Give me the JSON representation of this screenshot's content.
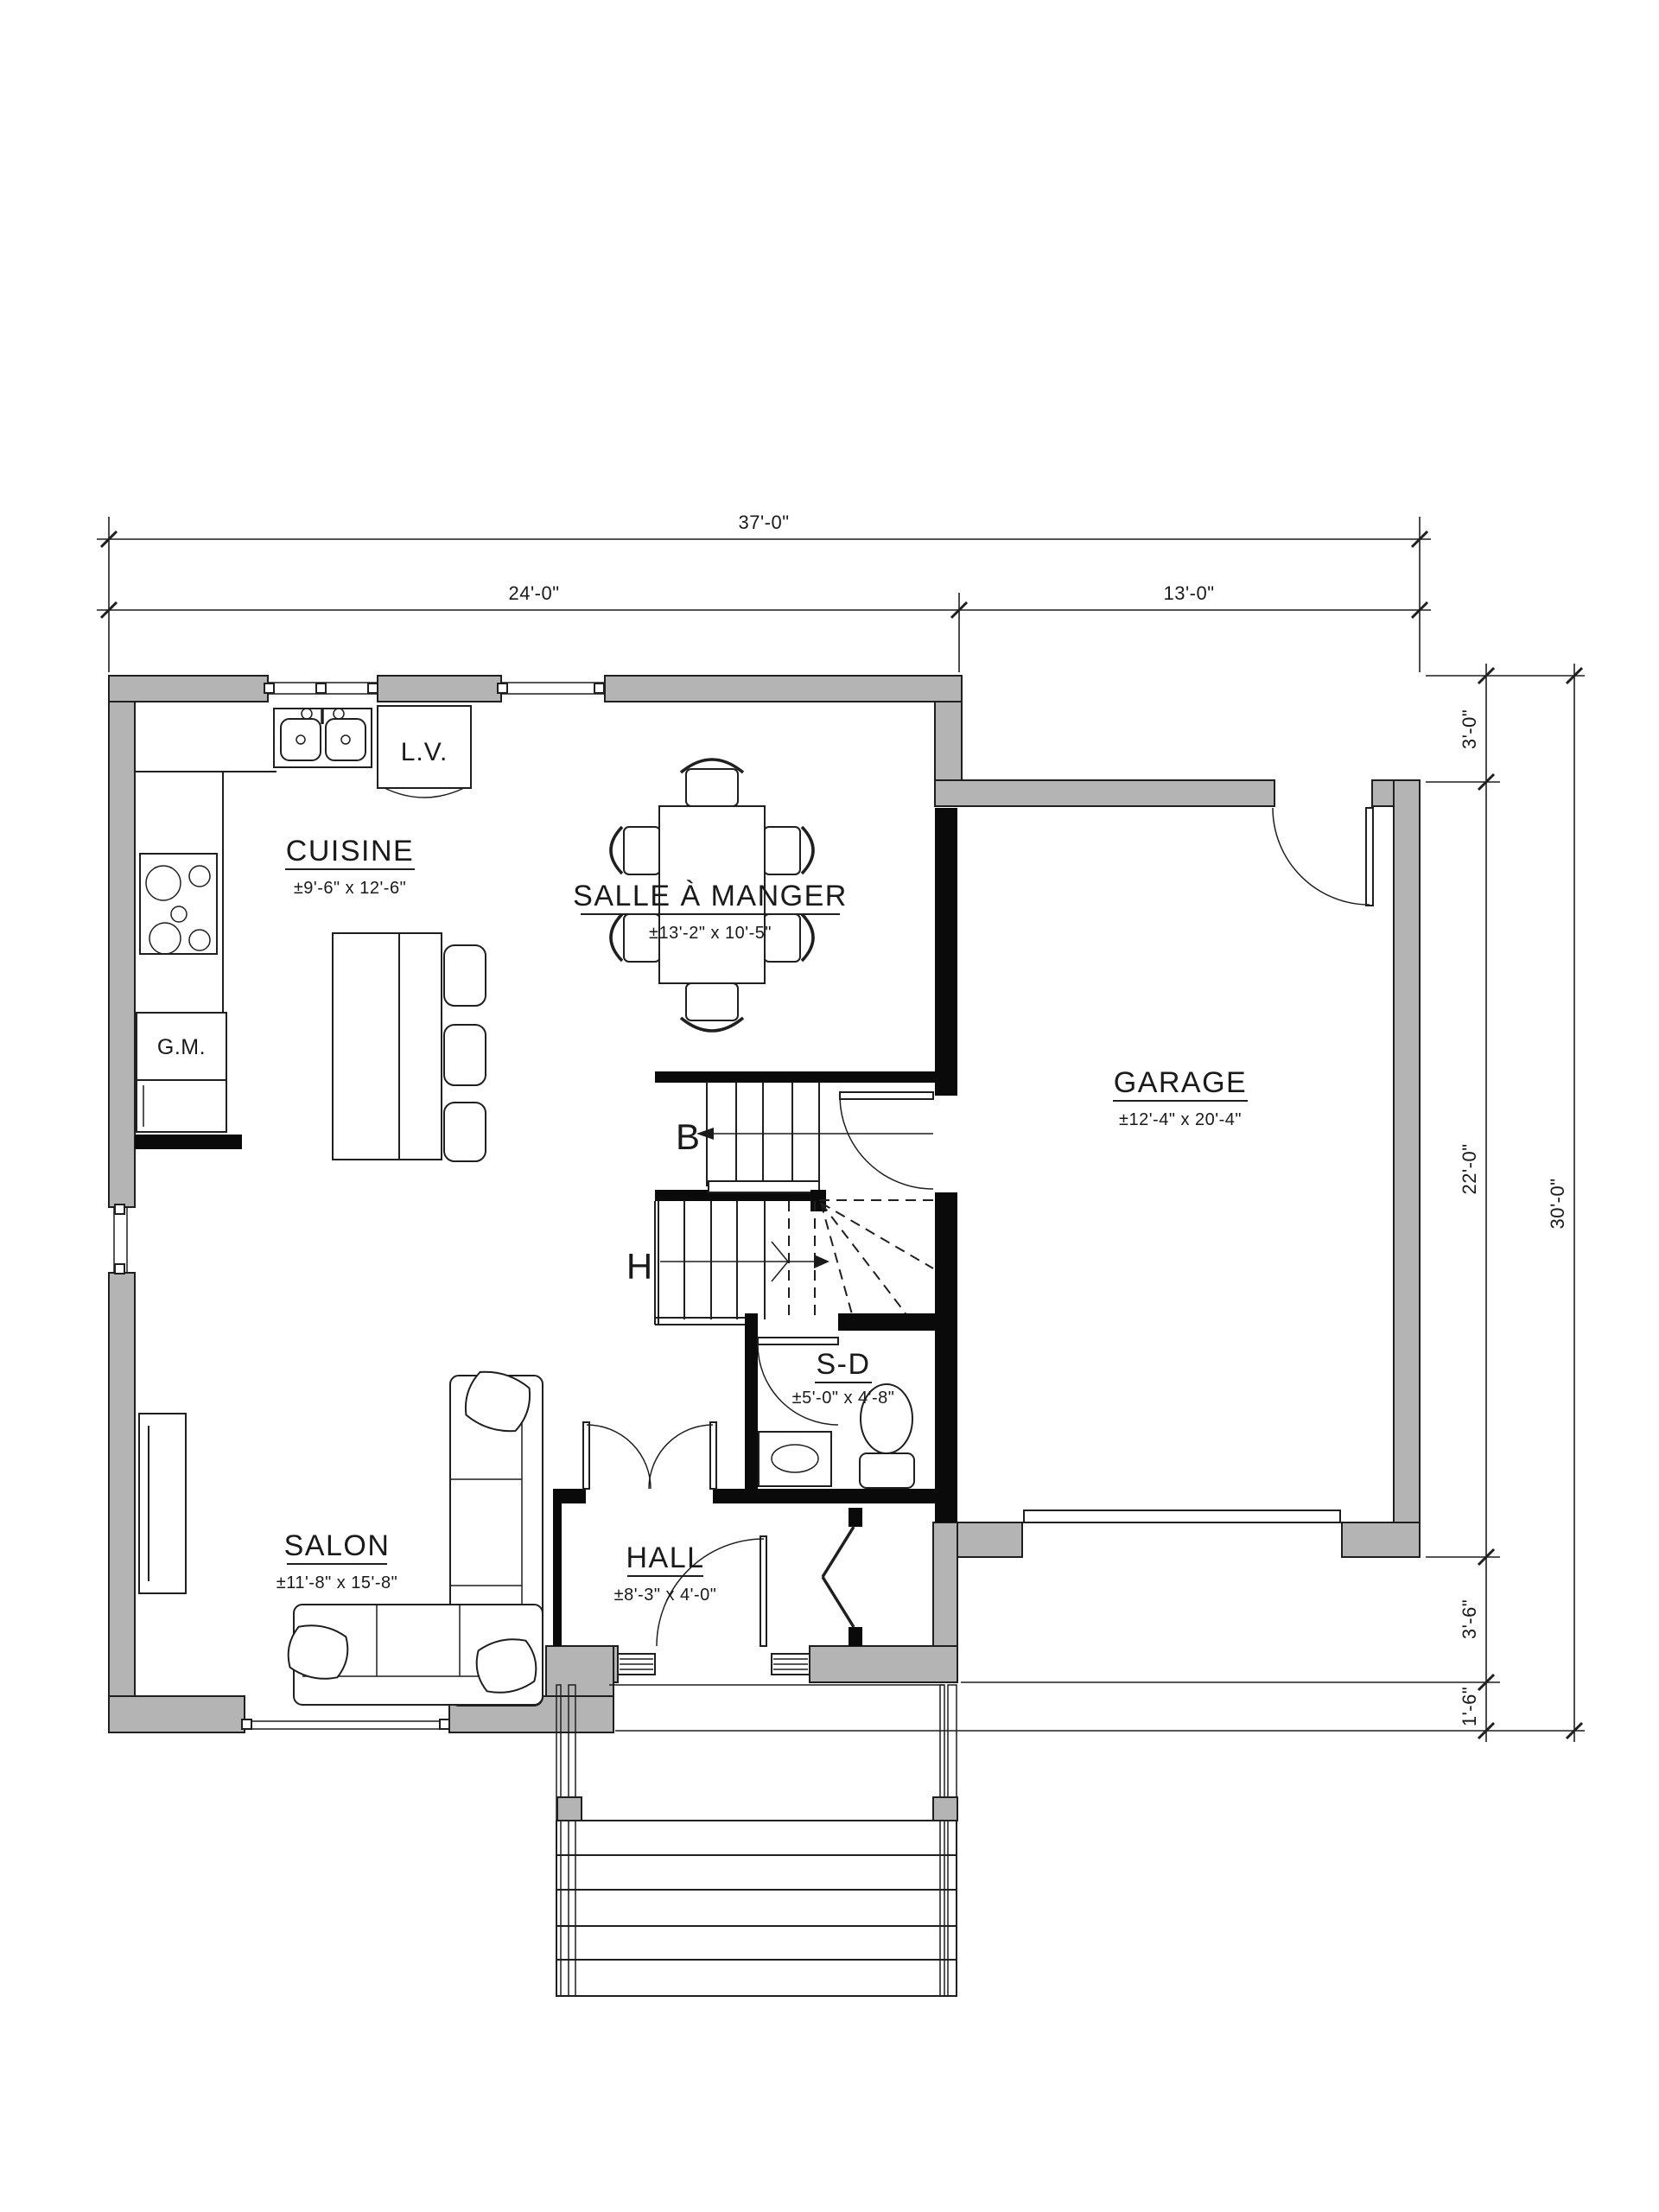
{
  "drawing": {
    "type": "residential floor plan",
    "language": "French"
  },
  "colors": {
    "wall_fill": "#b4b4b4",
    "line": "#1f1f1f",
    "interior_wall": "#0a0a0a",
    "background": "#ffffff"
  },
  "rooms": {
    "cuisine": {
      "name": "CUISINE",
      "dims": "±9'-6\" x 12'-6\""
    },
    "salle_a_manger": {
      "name": "SALLE À MANGER",
      "dims": "±13'-2\" x 10'-5\""
    },
    "garage": {
      "name": "GARAGE",
      "dims": "±12'-4\" x 20'-4\""
    },
    "salon": {
      "name": "SALON",
      "dims": "±11'-8\" x 15'-8\""
    },
    "hall": {
      "name": "HALL",
      "dims": "±8'-3\" x 4'-0\""
    },
    "salle_eau": {
      "name": "S-D",
      "dims": "±5'-0\" x 4'-8\""
    }
  },
  "labels": {
    "dishwasher": "L.V.",
    "pantry": "G.M.",
    "stair_down": "B",
    "stair_up": "H"
  },
  "dimensions": {
    "top_total": "37'-0\"",
    "top_left": "24'-0\"",
    "top_right": "13'-0\"",
    "right_recess": "3'-0\"",
    "right_garage": "22'-0\"",
    "right_porch": "3'-6\"",
    "right_step": "1'-6\"",
    "right_total": "30'-0\""
  }
}
